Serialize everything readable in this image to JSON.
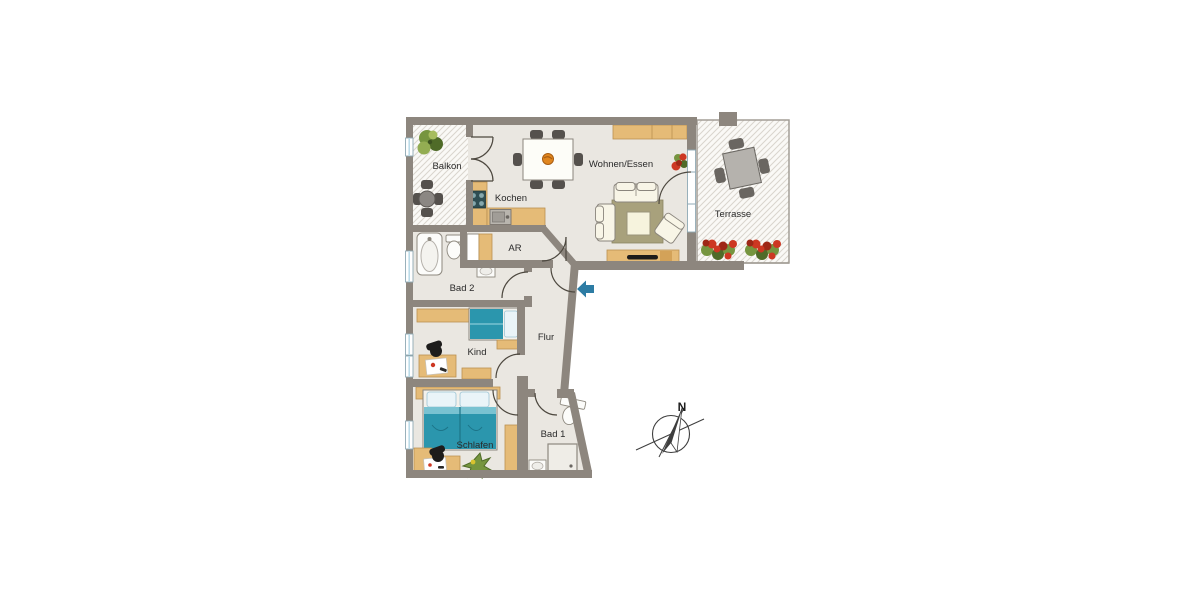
{
  "plan": {
    "title": "apartment-floor-plan",
    "rooms": {
      "balkon": "Balkon",
      "kochen": "Kochen",
      "wohnen_essen": "Wohnen/Essen",
      "terrasse": "Terrasse",
      "ar": "AR",
      "bad2": "Bad 2",
      "kind": "Kind",
      "flur": "Flur",
      "schlafen": "Schlafen",
      "bad1": "Bad 1"
    },
    "compass": {
      "north": "N"
    },
    "entrance_icon": "blue-left-arrow"
  },
  "colors": {
    "wall": "#8d867e",
    "floor": "#eae7e1",
    "outdoor": "#faf9f6",
    "hatch": "#d9d5cd",
    "outline": "#8a857d",
    "door": "#4d483f",
    "wood": "#e5bb77",
    "wood-dark": "#bb9150",
    "teal": "#2b96ad",
    "teal-light": "#79c2d1",
    "pillow": "#eaf4f8",
    "window-frame": "#8fa9b4",
    "window-blue": "#bcdce9",
    "rug": "#a8a17c",
    "sofa": "#f8f5e7",
    "chair": "#55514d",
    "red": "#cd3722",
    "red-dark": "#9e2716",
    "green": "#76953f",
    "green-dark": "#4f6b28",
    "arrow": "#2d7ca4",
    "fixture": "#fcfcfa",
    "fixture-stroke": "#8e897f",
    "metal": "#b9b5ae",
    "label": "#2a2a2a",
    "tv": "#1c1b1a",
    "orange": "#e0861f",
    "compass": "#3e3e3e"
  }
}
